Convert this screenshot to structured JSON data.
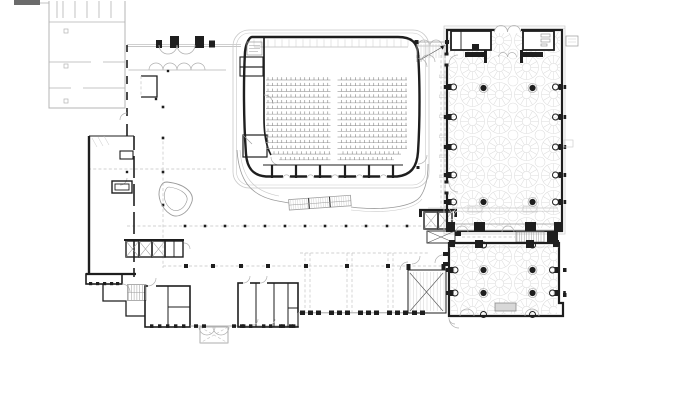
{
  "palette": {
    "background": "#ffffff",
    "ink": "#1e1e1e",
    "wall_gray": "#b4b4b4",
    "detail_gray": "#9a9a9a",
    "arc_gray": "#b0b0b0",
    "light_gray": "#c9c9c9",
    "pattern_gray": "#dcdcdc",
    "dash_gray": "#c4c4c4",
    "hatch_gray": "#8f8f8f",
    "fill_light": "#d8d8d8",
    "tick_gray": "#6e6e6e"
  },
  "auditorium": {
    "seat_rows": {
      "count": 15,
      "y_start": 80,
      "spacing": 5.7,
      "x_left": 266,
      "x_right": 407,
      "aisle_left": 330.5,
      "aisle_right": 337.5,
      "tick_step": 4.6,
      "tick_height": 2.8,
      "row_insets": {
        "13": 6,
        "14": 13
      }
    },
    "gallery_band": {
      "x_start": 254,
      "x_end": 408,
      "tick_step": 7,
      "y_top": 39.5,
      "y_line": 47
    },
    "stage": {
      "divider_xs": [
        272,
        296,
        320,
        345,
        369,
        393
      ],
      "door_gap_xs": [
        283,
        307,
        331.5,
        356,
        380
      ],
      "door_gap_w": 7
    }
  },
  "foyer": {
    "dash_lines": [
      [
        88,
        169,
        226,
        169
      ],
      [
        163,
        136,
        163,
        268
      ],
      [
        127,
        226,
        445,
        226
      ],
      [
        163,
        266,
        448,
        266
      ],
      [
        300,
        253,
        428,
        253
      ],
      [
        441,
        55,
        441,
        208
      ],
      [
        445,
        55,
        445,
        208
      ],
      [
        305,
        253,
        305,
        312
      ],
      [
        310,
        253,
        310,
        312
      ],
      [
        347,
        253,
        347,
        312
      ],
      [
        352,
        253,
        352,
        312
      ],
      [
        388,
        253,
        388,
        312
      ],
      [
        393,
        253,
        393,
        312
      ],
      [
        462,
        237,
        515,
        237
      ]
    ],
    "colonnade_tick_ys": [
      75,
      95,
      115,
      135,
      155,
      175
    ],
    "columns_small": {
      "y": 226,
      "size": 2.6,
      "xs": [
        185,
        205,
        225,
        245,
        265,
        285,
        305,
        325,
        346,
        366,
        387,
        407
      ]
    },
    "columns_large": {
      "y": 266,
      "size": 4,
      "xs": [
        186,
        213,
        241,
        268,
        306,
        347,
        388
      ]
    },
    "columns_west": {
      "x": 163,
      "size": 2.6,
      "ys": [
        107,
        138,
        172,
        205
      ]
    },
    "columns_extra": [
      [
        156,
        99
      ],
      [
        127,
        172
      ],
      [
        168,
        71
      ]
    ],
    "elevators_west": {
      "y": 241,
      "h": 16,
      "w": 13,
      "xs": [
        126,
        139,
        152
      ]
    },
    "elevators_east": {
      "y": 212,
      "h": 17,
      "w": 14,
      "xs": [
        424,
        438
      ]
    }
  },
  "south_edge": {
    "curtain_posts": {
      "y": 310.5,
      "w": 5,
      "h": 4.5,
      "xs": [
        300,
        308,
        316,
        329,
        337,
        345,
        358,
        366,
        374,
        387,
        395,
        403,
        412,
        420
      ]
    },
    "glass_posts": {
      "y": 324.3,
      "w": 4,
      "h": 3.6,
      "xs": [
        194,
        202,
        232,
        240,
        281,
        289
      ]
    },
    "band_posts": {
      "y": 282,
      "w": 3.2,
      "h": 3.2,
      "xs": [
        89,
        96,
        103,
        110,
        116
      ]
    },
    "clusterA_posts": {
      "y": 324.3,
      "w": 3.4,
      "h": 3.6,
      "xs": [
        150,
        158,
        166,
        174,
        182
      ]
    },
    "clusterB_posts": {
      "y": 324.3,
      "w": 3.4,
      "h": 3.6,
      "xs": [
        242,
        249,
        262,
        269,
        279,
        292
      ]
    }
  },
  "halls": {
    "upper": {
      "pilaster_ys": [
        87,
        117,
        147,
        175,
        202
      ],
      "columns": [
        [
          483.5,
          88
        ],
        [
          532.5,
          88
        ],
        [
          483.5,
          202
        ],
        [
          532.5,
          202
        ]
      ]
    },
    "lower": {
      "pilaster_ys": [
        270,
        293
      ],
      "columns": [
        [
          483.5,
          270
        ],
        [
          532.5,
          270
        ],
        [
          483.5,
          293
        ],
        [
          532.5,
          293
        ]
      ],
      "attached": [
        [
          483.5,
          245
        ],
        [
          532.5,
          245
        ],
        [
          483.5,
          314.5
        ],
        [
          532.5,
          314.5
        ]
      ]
    }
  },
  "stairs": {
    "ne": {
      "x1": 421,
      "x2": 445,
      "step": 3,
      "y1": 44,
      "y2": 58
    },
    "se": {
      "x1": 410,
      "x2": 444,
      "step": 3.4,
      "y1": 272,
      "y2": 311
    },
    "escalator": {
      "x1": 128.5,
      "x2": 145.5,
      "step": 2.8,
      "y1": 285,
      "y2": 300
    },
    "hall_gap": {
      "x1": 517,
      "x2": 543,
      "step": 2.4,
      "y1": 232.5,
      "y2": 241.5
    },
    "steps_bar": {
      "x": 289,
      "y": 199.5,
      "w": 62,
      "h": 10.5,
      "step": 2.3,
      "dividers": [
        309,
        330
      ],
      "rotate_deg": -4
    }
  }
}
